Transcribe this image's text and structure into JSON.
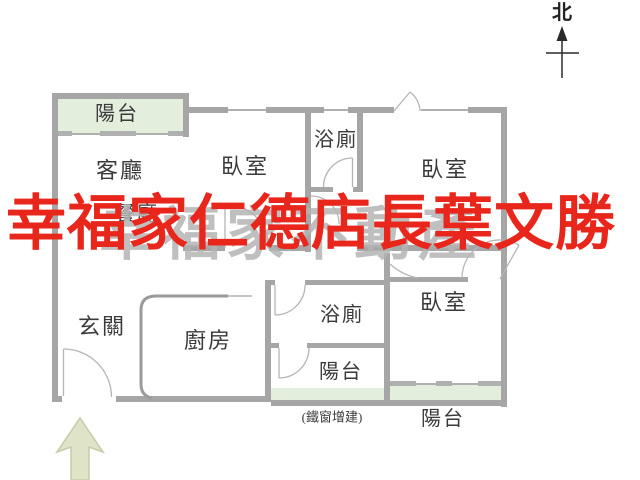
{
  "plan": {
    "title": "apartment-floor-plan",
    "north_label": "北",
    "watermark_red": "幸福家仁德店長葉文勝",
    "watermark_gray": "幸福家不動產",
    "rooms": {
      "balcony_top": "陽台",
      "living": "客廳",
      "dining": "餐廳",
      "bedroom_top_mid": "臥室",
      "bath_top": "浴廁",
      "bedroom_top_right": "臥室",
      "entry": "玄關",
      "kitchen": "廚房",
      "bath_bottom": "浴廁",
      "balcony_mid": "陽台",
      "bedroom_bottom_right": "臥室",
      "balcony_bottom_right": "陽台",
      "note_iron_window": "(鐵窗增建)"
    },
    "colors": {
      "wall": "#a6a6a6",
      "thin_line": "#b0b0b0",
      "balcony_fill": "#e3eedd",
      "entry_arrow_fill": "#dfe4c9",
      "entry_arrow_stroke": "#c6cca8",
      "watermark_red": "#e8261c",
      "watermark_gray": "#b4b4b4",
      "label_text": "#3a3a3a",
      "north_arrow": "#2a2a2a"
    }
  }
}
